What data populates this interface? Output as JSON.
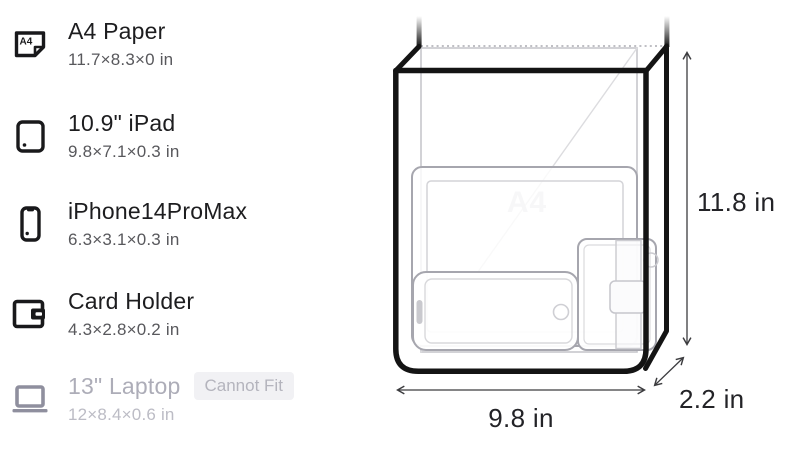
{
  "sidebar": {
    "items": [
      {
        "label": "A4 Paper",
        "dims": "11.7×8.3×0 in",
        "icon": "a4-paper-icon",
        "fits": true
      },
      {
        "label": "10.9\" iPad",
        "dims": "9.8×7.1×0.3 in",
        "icon": "ipad-icon",
        "fits": true
      },
      {
        "label": "iPhone14ProMax",
        "dims": "6.3×3.1×0.3 in",
        "icon": "iphone-icon",
        "fits": true
      },
      {
        "label": "Card Holder",
        "dims": "4.3×2.8×0.2 in",
        "icon": "card-holder-icon",
        "fits": true
      },
      {
        "label": "13\" Laptop",
        "dims": "12×8.4×0.6 in",
        "icon": "laptop-icon",
        "fits": false,
        "badge": "Cannot Fit"
      }
    ]
  },
  "diagram": {
    "watermark": "A4",
    "height_label": "11.8 in",
    "width_label": "9.8 in",
    "depth_label": "2.2 in"
  },
  "colors": {
    "ink": "#141414",
    "item_outline": "#a6a6ae",
    "item_detail": "#d6d6da",
    "watermark": "#d2d2d6",
    "dotted_edge": "#bfbfc4",
    "annotation": "#3c3c3f",
    "muted_text": "#58585c",
    "disabled_text": "#adadb8",
    "badge_bg": "#f1f1f4",
    "badge_text": "#b4b4bd"
  }
}
